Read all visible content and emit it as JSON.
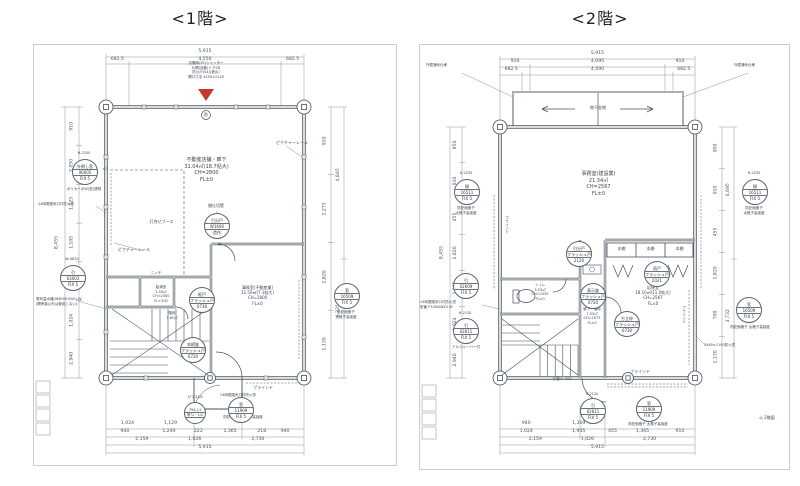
{
  "floor1": {
    "title": "<1階>",
    "entrance_note": [
      "店舗用(ST)シャッター",
      "片開(自動)ドアSD",
      "防火戸(S4)(遮炎)",
      "開口寸法 4550×2140"
    ],
    "circled_mark": "防",
    "dims": {
      "top_total": "5,915",
      "top_row": [
        "682.5",
        "4,550",
        "682.5"
      ],
      "left_inner": [
        "910",
        "2,050",
        "1,125",
        "1,105",
        "455",
        "1,024",
        "2,940"
      ],
      "left_outer": [
        "8,455"
      ],
      "right_inner": [
        "910",
        "2,275",
        "1,820",
        "1,130"
      ],
      "right_outer": [
        "4,845",
        "4,325"
      ],
      "bottom_row1": [
        "1,024",
        "1,129"
      ],
      "bottom_row2": [
        "940",
        "1,249",
        "222",
        "1,365",
        "218",
        "940"
      ],
      "bottom_row3": [
        "2,159",
        "1,026",
        "2,730"
      ],
      "bottom_total": "5,915"
    },
    "rooms": {
      "main": [
        "不動産店舗・廊下",
        "31.04㎡(18.7帖大)",
        "CH=2800",
        "FL±0"
      ],
      "office": [
        "事務室(不動産業)",
        "11.59㎡(7.1帖大)",
        "CH=2800",
        "FL±0"
      ],
      "booth": "打合せブース",
      "niche": "ニッチ",
      "kitchen": [
        "給湯室",
        "2.50㎡",
        "CH=2400",
        "FL+200"
      ],
      "stair": [
        "階段",
        "1.65㎡"
      ],
      "hall": "玄関ホール"
    },
    "labels": {
      "picture_rail_left": "ピクチャーレール",
      "picture_rail_right": "ピクチャーレール",
      "partition": "間仕切壁",
      "blind": "ブラインド",
      "fire_window_left": "24時間換気口付防火窓",
      "fire_window_door": "24時間換気口付防火窓",
      "water_heater": "電気温水器(W600/H200)-W",
      "water_heater2": "(関係者以外は使用しない)"
    },
    "tags": {
      "window_left": {
        "note": "H-2200",
        "mult": "×3",
        "lines": [
          "外倒し窓",
          "06005",
          "FIX 5"
        ],
        "below": "ポリカーボW(型)透明"
      },
      "window_left2": {
        "note": "W-0830",
        "lines": [
          "引",
          "03003",
          "FIX 5"
        ]
      },
      "window_right": {
        "note": "窓",
        "lines": [
          "窓",
          "16509",
          "FIX 5"
        ],
        "below1": "防犯面格子",
        "below2": "太格子高強度"
      },
      "window_bottom": {
        "lines": [
          "窓",
          "11909",
          "FIX 5"
        ],
        "below": "防犯面格子 太格子高強度"
      },
      "glass_cb": {
        "note": "ガラスCB",
        "lines": [
          "794-11",
          "甲'U・1/2",
          ""
        ]
      },
      "door_main": {
        "lines": [
          "本締錠",
          "フラッシュ戸",
          "0720"
        ]
      },
      "door_stair": {
        "lines": [
          "框戸",
          "フラッシュ戸",
          "0730"
        ]
      },
      "partition_tag": {
        "lines": [
          "引分戸",
          "W1690",
          "造作"
        ]
      }
    }
  },
  "floor2": {
    "title": "<2階>",
    "corner_note_left": "外壁通気仕様",
    "corner_note_right": "外壁通気仕様",
    "balcony_label": "物干金物",
    "dims": {
      "top_total": "5,915",
      "top_row2": [
        "910",
        "4,095",
        "910"
      ],
      "top_row3": [
        "682.5",
        "4,590",
        "682.5"
      ],
      "left_inner": [
        "950",
        "910",
        "455",
        "1,820",
        "1,105",
        "1,024",
        "2,940"
      ],
      "left_outer": [
        "8,455"
      ],
      "right_inner": [
        "950",
        "910",
        "455",
        "1,820",
        "700",
        "1,130"
      ],
      "right_outer": [
        "4,695",
        "3,732"
      ],
      "bottom_row1": [
        "940",
        "1,369"
      ],
      "bottom_row2a": [
        "1,024",
        "1,935"
      ],
      "bottom_row2b": [
        "455",
        "1,365",
        "910"
      ],
      "bottom_row3": [
        "2,159",
        "1,026",
        "2,730"
      ],
      "bottom_total": "5,915"
    },
    "rooms": {
      "office": [
        "事務室(建設業)",
        "21.34㎡",
        "CH=2567",
        "FL±0"
      ],
      "reception": [
        "応接室",
        "18.10㎡(11.0帖大)",
        "CH=2567",
        "FL±0"
      ],
      "toilet": [
        "トイレ",
        "3.53㎡",
        "CH=2430",
        "FL±0"
      ],
      "hall": [
        "廊下・階段",
        "7.33㎡",
        "CH=2573",
        "FL±0"
      ],
      "shelf1": "本棚",
      "shelf2": "本棚",
      "shelf3": "本棚"
    },
    "labels": {
      "blind_bottom": "ブラインド",
      "blind_left": "ブラインド",
      "blind_right": "ブラインド",
      "handrail": "手摺H=700",
      "fire_window_left": "24時間換気口付防火窓",
      "fire_window_left2": "型番 FY-08XWX3-W",
      "fire_window_right": "2480×1100防火窓",
      "louver": "アルミルーバー付"
    },
    "tags": {
      "window_left_outer": {
        "note": "H-2230",
        "lines": [
          "掃",
          "16511",
          "FIX 5"
        ],
        "below1": "防犯面格子",
        "below2": "太格子高強度"
      },
      "window_right_outer": {
        "note": "H-2230",
        "lines": [
          "掃",
          "16511",
          "FIX 5"
        ],
        "below1": "防犯面格子",
        "below2": "太格子高強度"
      },
      "window_right_lower": {
        "lines": [
          "窓",
          "16509",
          "FIX 5"
        ],
        "below": "防犯面格子 太格子高強度"
      },
      "window_left_top": {
        "lines": [
          "引",
          "02609",
          "FIX 5"
        ]
      },
      "window_left_bottom": {
        "note": "H-2130",
        "lines": [
          "引",
          "02611",
          "FIX 5"
        ]
      },
      "window_bottom_left": {
        "note": "H-2120",
        "lines": [
          "引",
          "02611",
          "FIX 5"
        ]
      },
      "window_bottom_right": {
        "lines": [
          "窓",
          "11909",
          "FIX 5"
        ],
        "below": "防犯面格子 太格子高強度"
      },
      "door_center": {
        "lines": [
          "引分戸",
          "フラッシュ戸",
          "2120"
        ]
      },
      "door_toilet": {
        "lines": [
          "表示錠",
          "フラッシュ戸",
          "0720"
        ]
      },
      "door_reception_top": {
        "lines": [
          "雨戸",
          "フラッシュ戸",
          "2021"
        ]
      },
      "door_reception": {
        "lines": [
          "方立枠",
          "フラッシュ戸",
          "0730"
        ]
      }
    },
    "footer_note": "◎ 2階図"
  }
}
